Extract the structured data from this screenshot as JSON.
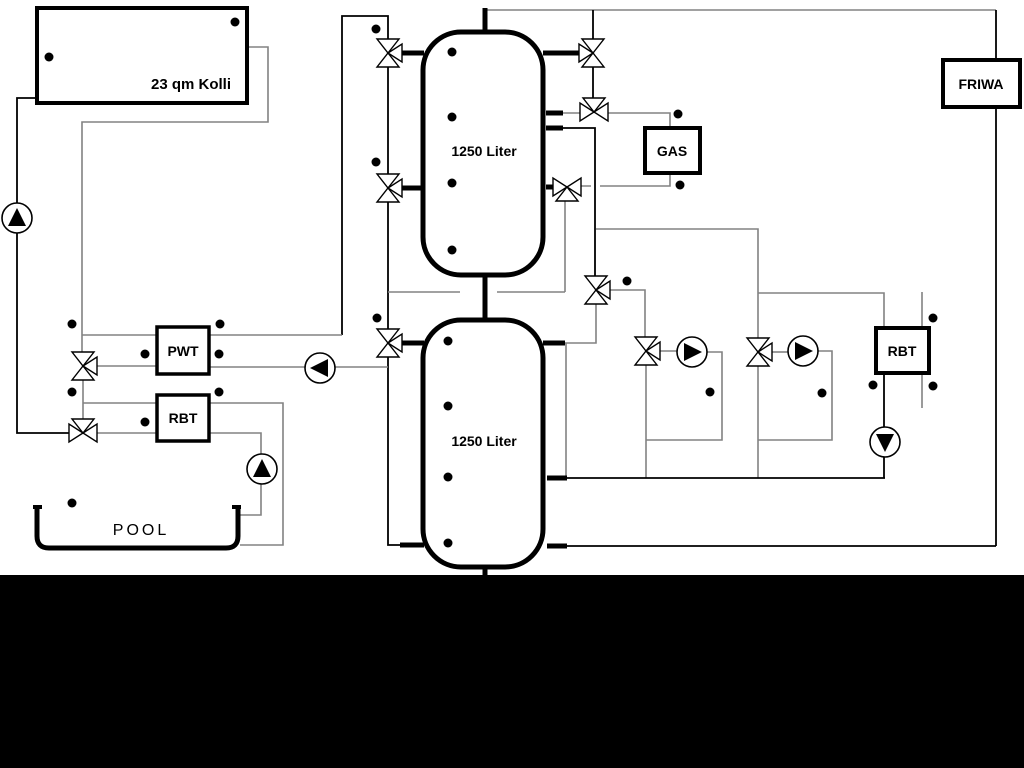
{
  "diagram": {
    "collector_label": "23 qm Kolli",
    "tank_top_label": "1250 Liter",
    "tank_bottom_label": "1250 Liter",
    "pwt_label": "PWT",
    "rbt_left_label": "RBT",
    "gas_label": "GAS",
    "rbt_right_label": "RBT",
    "friwa_label": "FRIWA",
    "pool_label": "POOL",
    "colors": {
      "line_black": "#000000",
      "line_gray": "#828282",
      "background": "#ffffff",
      "bottom_band": "#000000"
    },
    "icons": {
      "pump": "pump-icon",
      "three_way_valve": "three-way-valve-icon",
      "temperature_sensor": "temperature-sensor-icon"
    }
  }
}
